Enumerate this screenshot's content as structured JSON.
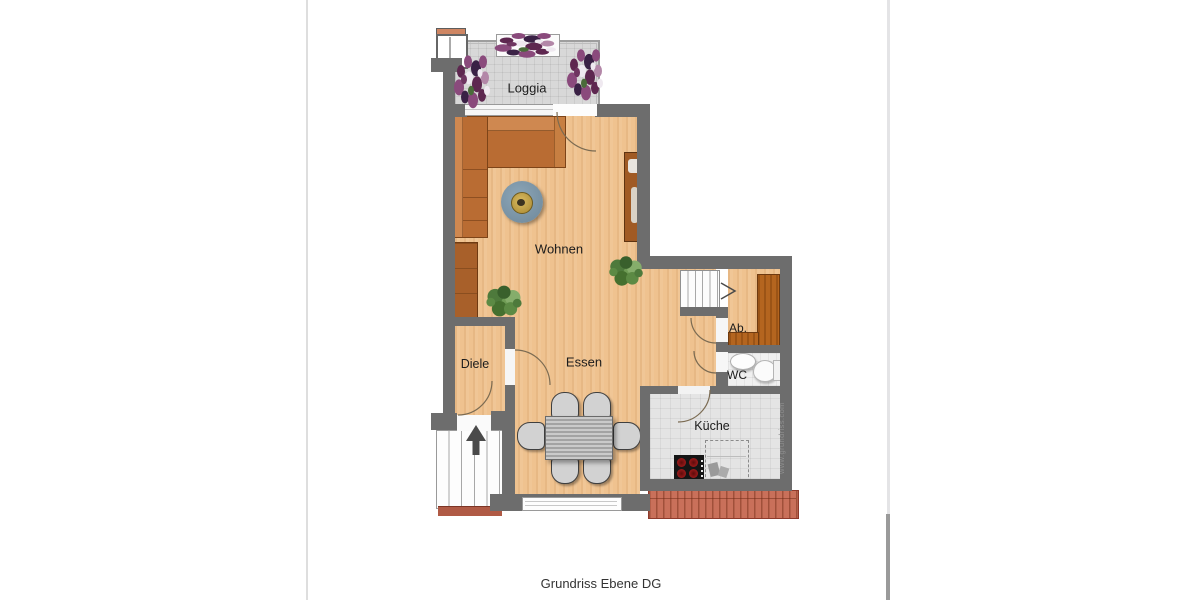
{
  "caption": "Grundriss Ebene DG",
  "watermark": "www.grundriss.com",
  "rooms": {
    "loggia": "Loggia",
    "wohnen": "Wohnen",
    "diele": "Diele",
    "essen": "Essen",
    "abstellraum": "Ab.",
    "wc": "WC",
    "kueche": "Küche"
  },
  "colors": {
    "wall": "#6d6d6d",
    "wood_floor": "#efc28f",
    "loggia_tile": "#d8d8d8",
    "kitchen_tile": "#e4e4e4",
    "wc_tile": "#f0f0f0",
    "furniture_brown": "#b96c33",
    "rug_blue": "#7e96a8",
    "roof_terracotta": "#c9705a",
    "label_text": "#1c1c1c"
  }
}
